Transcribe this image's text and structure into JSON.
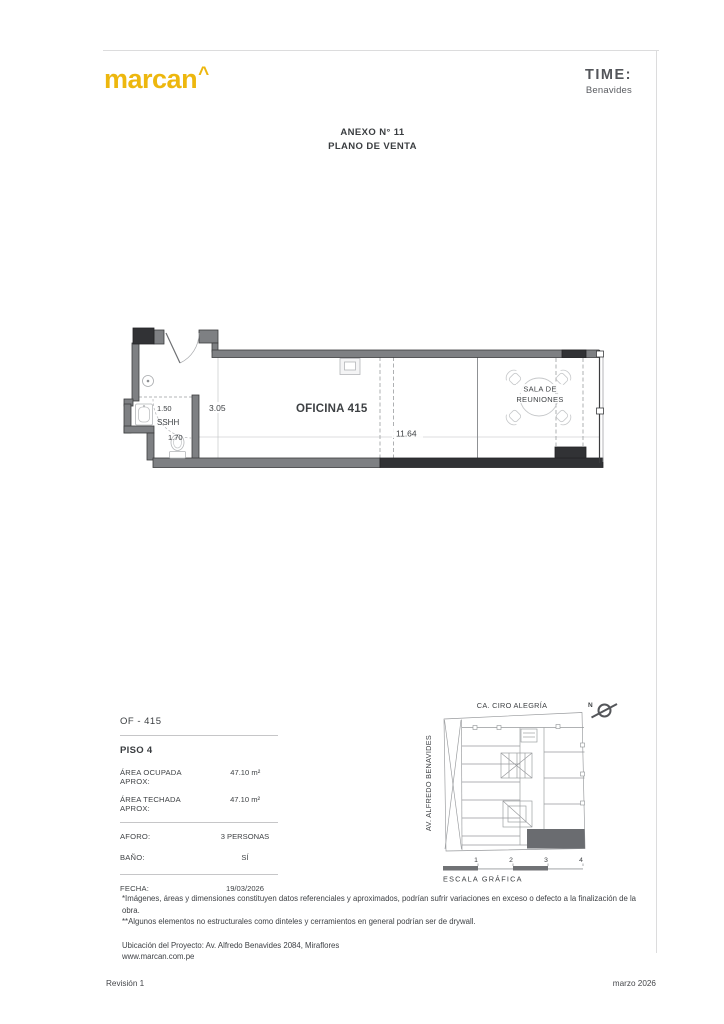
{
  "header": {
    "brand": "marcan",
    "brand_mark": "^",
    "partner_name": "TIME:",
    "partner_location": "Benavides"
  },
  "title": {
    "line1": "ANEXO N° 11",
    "line2": "PLANO DE VENTA"
  },
  "floor_plan": {
    "office_label": "OFICINA 415",
    "meeting_room_label_line1": "SALA DE",
    "meeting_room_label_line2": "REUNIONES",
    "bathroom_label": "SSHH",
    "dims": {
      "width": "11.64",
      "depth": "3.05",
      "bath_width": "1.50",
      "bath_depth": "1.70"
    }
  },
  "details": {
    "unit_code": "OF - 415",
    "floor_label": "PISO 4",
    "area_rows": [
      {
        "label": "ÁREA OCUPADA APROX:",
        "value": "47.10 m²"
      },
      {
        "label": "ÁREA TECHADA APROX:",
        "value": "47.10 m²"
      }
    ],
    "info_rows": [
      {
        "label": "AFORO:",
        "value": "3 PERSONAS"
      },
      {
        "label": "BAÑO:",
        "value": "SÍ"
      }
    ],
    "date_row": {
      "label": "FECHA:",
      "value": "19/03/2026"
    }
  },
  "site_map": {
    "street_top": "CA. CIRO ALEGRÍA",
    "street_left": "AV. ALFREDO BENAVIDES",
    "north_label": "N",
    "scale_ticks": [
      "1",
      "2",
      "3",
      "4"
    ],
    "scale_caption": "ESCALA GRÁFICA"
  },
  "notes": {
    "disclaimer1": "*Imágenes, áreas y dimensiones constituyen datos referenciales y aproximados, podrían sufrir variaciones en exceso o defecto a la finalización de la obra.",
    "disclaimer2": "**Algunos elementos no estructurales como dinteles y cerramientos en general podrían ser de drywall.",
    "project_location": "Ubicación del Proyecto: Av. Alfredo Benavides 2084, Miraflores",
    "website": "www.marcan.com.pe"
  },
  "footer": {
    "revision": "Revisión 1",
    "date": "marzo 2026"
  },
  "colors": {
    "brand_yellow": "#EDB70E",
    "wall_gray": "#7E8083",
    "wall_dark": "#313235",
    "unit_highlight": "#6A6C70"
  }
}
